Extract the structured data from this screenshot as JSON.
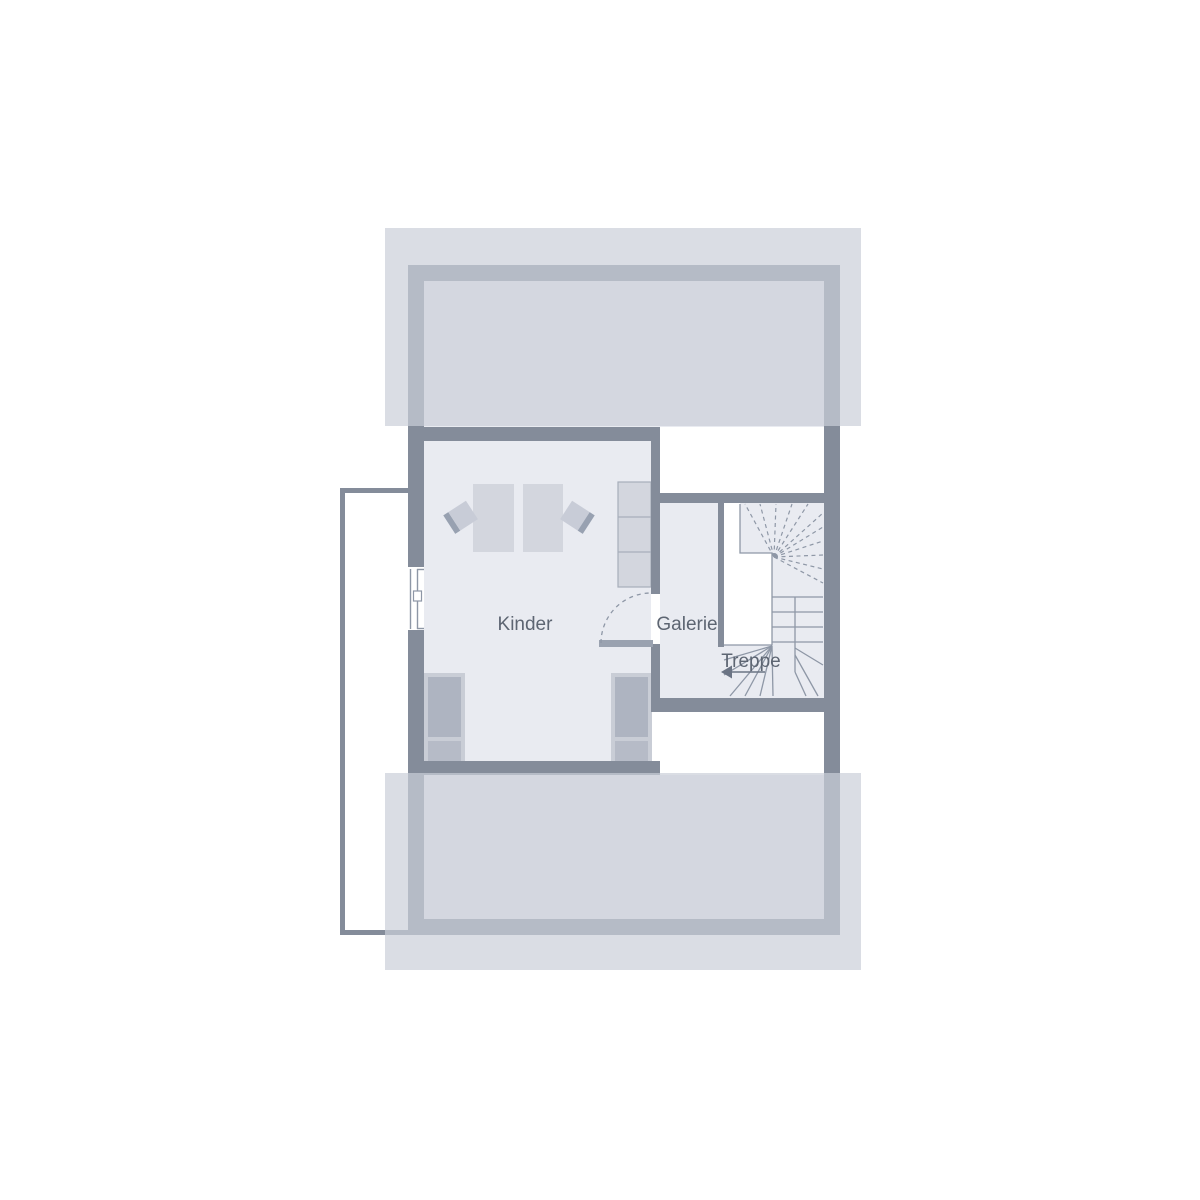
{
  "floor_plan": {
    "room_labels": [
      {
        "id": "kinder",
        "label": "Kinder"
      },
      {
        "id": "galerie",
        "label": "Galerie"
      },
      {
        "id": "treppe",
        "label": "Treppe"
      }
    ],
    "elements": {
      "staircase": "winder-stairs-with-landing-void",
      "stair_direction_arrow": "left",
      "window_count": 1,
      "door_count": 1,
      "bed_count": 2,
      "desk_count": 2,
      "chair_count": 2,
      "wardrobe_count": 1,
      "balcony": "left-side"
    }
  },
  "colors": {
    "background": "#ffffff",
    "wall": "#848c9a",
    "room_fill": "#e9ebf1",
    "roof_overlay": "rgba(203,206,217,0.7)",
    "furniture_light": "#d3d6de",
    "furniture_line": "#a7aebb",
    "bed_frame": "#c9cdd6",
    "bed_mattress": "#aeb4c1",
    "bed_foot": "#b6bbc7",
    "chair_seat": "#c8ccd7",
    "chair_back": "#98a1b1",
    "stair_line": "#8e97a6",
    "door_leaf": "#9aa2b0",
    "label_text": "#5d6572",
    "arrow_color": "#6b7484"
  }
}
